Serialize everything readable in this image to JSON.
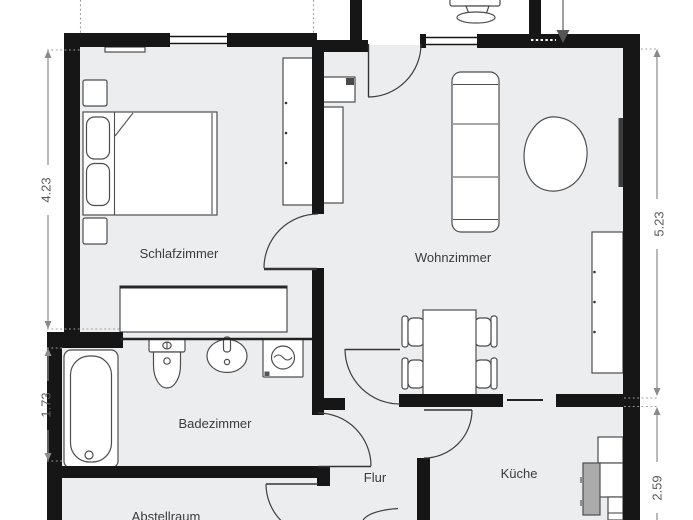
{
  "plan": {
    "type": "apartment-floorplan",
    "rooms": [
      {
        "name": "Schlafzimmer",
        "furniture": [
          "double-bed",
          "pillows",
          "nightstand-top",
          "nightstand-bottom",
          "wardrobe",
          "dresser",
          "radiator"
        ]
      },
      {
        "name": "Wohnzimmer",
        "furniture": [
          "sofa",
          "beanbag",
          "tv-shelf",
          "tv",
          "lowboard",
          "sideboard",
          "dining-table",
          "chairs-4",
          "wall-radiator"
        ]
      },
      {
        "name": "Badezimmer",
        "furniture": [
          "bathtub",
          "toilet",
          "washbasin",
          "washing-machine"
        ]
      },
      {
        "name": "Flur",
        "furniture": []
      },
      {
        "name": "Küche",
        "furniture": [
          "counter-cabinets",
          "appliance-unit"
        ]
      },
      {
        "name": "Abstellraum",
        "furniture": []
      }
    ],
    "vestibule_fixture": "pedestal-fixture",
    "entrance_marker": "arrow",
    "dimensions": [
      {
        "value": "4.23",
        "side": "left",
        "section": "upper"
      },
      {
        "value": "1.73",
        "side": "left",
        "section": "lower"
      },
      {
        "value": "5.23",
        "side": "right",
        "section": "upper"
      },
      {
        "value": "2.59",
        "side": "right",
        "section": "lower"
      }
    ],
    "colors": {
      "wall": "#161616",
      "floor": "#ECEDEF",
      "furniture_stroke": "#4D4D4D",
      "dimension": "#8A8A8A",
      "label": "#3B3B3B",
      "background": "#FFFFFF"
    }
  }
}
